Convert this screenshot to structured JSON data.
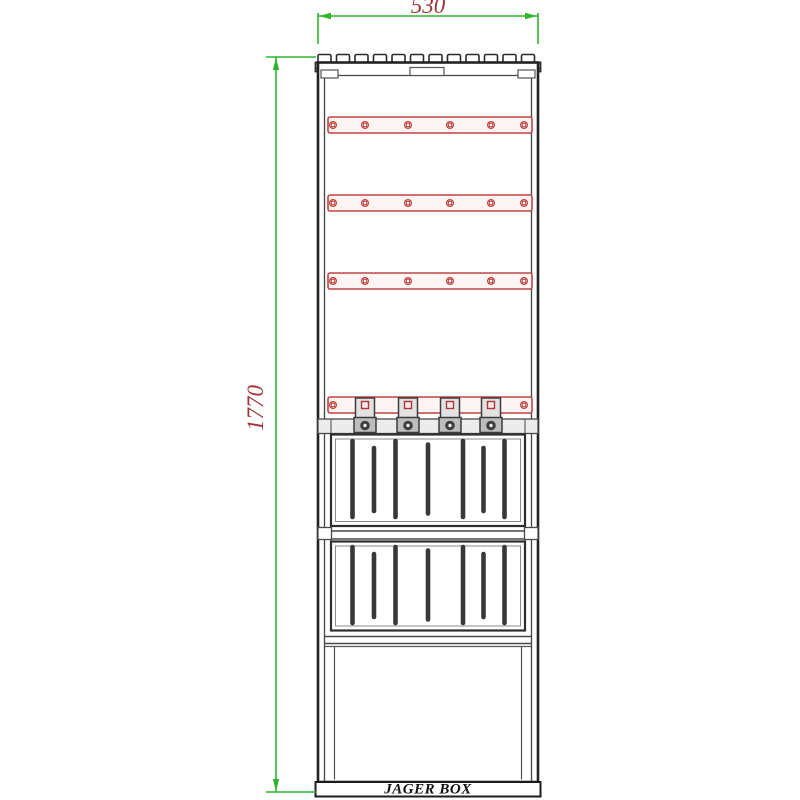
{
  "drawing": {
    "kind": "electrical cabinet front-view technical drawing"
  },
  "dimensions": {
    "width_label": "530",
    "height_label": "1770"
  },
  "brand": {
    "label": "JAGER BOX"
  },
  "colors": {
    "dimension_line_green": "#2db52d",
    "dimension_text_red": "#9e3339",
    "busbar_red": "#c04545",
    "outline_dark": "#2a2a2a",
    "clamp_gray": "#bdbdbd",
    "background": "#ffffff"
  },
  "components": {
    "roof_rib_count": 12,
    "busbar_count": 4,
    "holes_per_busbar": 6,
    "cable_clamp_count": 4,
    "louver_panel_count": 2,
    "slats_per_panel": 7
  }
}
